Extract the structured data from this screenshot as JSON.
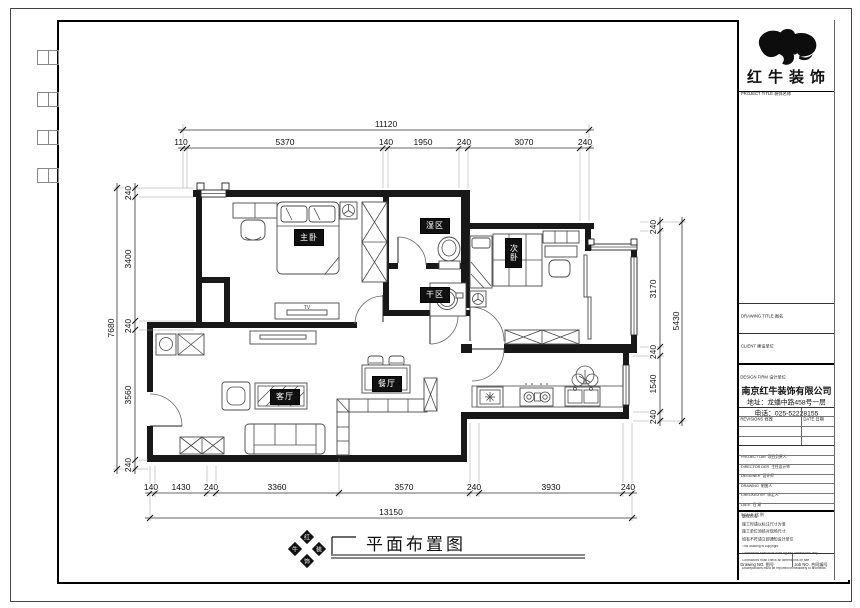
{
  "title_block": {
    "brand": "红牛装饰",
    "project_title_label": "PROJECT TITLE  装饰名称",
    "drawing_title_label": "DRAWING TITLE  图名",
    "client_label": "CLIENT  建设单位",
    "design_firm_label": "DESIGN FIRM  设计单位",
    "company_name": "南京红牛装饰有限公司",
    "company_address": "地址：龙蟠中路458号一层",
    "company_phone": "电话：025-52228155",
    "revisions_label": "REVISIONS  修改",
    "date_label": "DATE  日期",
    "rows": [
      {
        "en": "PROJECT DIR",
        "cn": "项目负责人"
      },
      {
        "en": "DIRECTOR DER",
        "cn": "主任设计师"
      },
      {
        "en": "DESIGNER",
        "cn": "设计师"
      },
      {
        "en": "DRAWING",
        "cn": "制图人"
      },
      {
        "en": "CHECKED BY",
        "cn": "审定人"
      },
      {
        "en": "DATE",
        "cn": "日  期"
      },
      {
        "en": "SCALE",
        "cn": "比  例"
      }
    ],
    "notes_cn": [
      "版权所有",
      "施工时请以标注尺寸为准",
      "施工单位须核对现场尺寸",
      "如有不符请立即通知设计单位"
    ],
    "notes_en": [
      "This drawing is copyright",
      "Contractors shall work from figured dimensions only",
      "Contractors must check all dimensions on site",
      "Discrepancies must be reported immediately to architects"
    ],
    "drawing_no_label": "Drawing NO. 图号",
    "job_no_label": "Job NO. 合同编号"
  },
  "drawing": {
    "caption": "平面布置图",
    "logo_chars": [
      "红",
      "牛",
      "装",
      "饰"
    ],
    "tv_label": "TV",
    "rooms": {
      "master": "主卧",
      "wet_area": "湿区",
      "dry_area": "干区",
      "second": "次卧",
      "living": "客厅",
      "dining": "餐厅"
    },
    "dimensions": {
      "top": {
        "total": "11120",
        "segments": [
          "110",
          "5370",
          "140",
          "1950",
          "240",
          "3070",
          "240"
        ]
      },
      "bottom": {
        "total": "13150",
        "segments": [
          "140",
          "1430",
          "240",
          "3360",
          "3570",
          "240",
          "3930",
          "240"
        ]
      },
      "left": {
        "total": "7680",
        "segments": [
          "240",
          "3400",
          "240",
          "3560",
          "240"
        ]
      },
      "right": {
        "total": "5430",
        "segments": [
          "240",
          "3170",
          "240",
          "1540",
          "240"
        ]
      }
    }
  }
}
